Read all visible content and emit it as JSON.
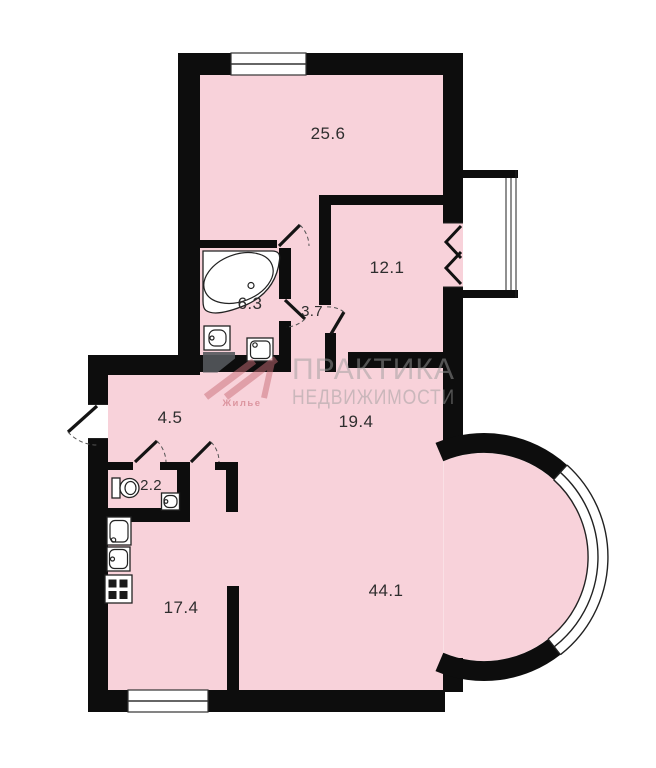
{
  "plan": {
    "rooms": [
      {
        "id": "room-25-6",
        "area": "25.6"
      },
      {
        "id": "room-12-1",
        "area": "12.1"
      },
      {
        "id": "bathroom-6-3",
        "area": "6.3"
      },
      {
        "id": "hall-3-7",
        "area": "3.7"
      },
      {
        "id": "hallway-4-5",
        "area": "4.5"
      },
      {
        "id": "wc-2-2",
        "area": "2.2"
      },
      {
        "id": "living-19-4",
        "area": "19.4"
      },
      {
        "id": "kitchen-17-4",
        "area": "17.4"
      },
      {
        "id": "room-44-1",
        "area": "44.1"
      }
    ],
    "colors": {
      "room_fill": "#f8d2da",
      "wall": "#0d0d0d",
      "watermark_text": "#9b9b9b",
      "logo_accent": "#c96d78"
    }
  },
  "watermark": {
    "line1": "ПРАКТИКА",
    "line2": "НЕДВИЖИМОСТИ",
    "logo_caption": "Жилье"
  }
}
